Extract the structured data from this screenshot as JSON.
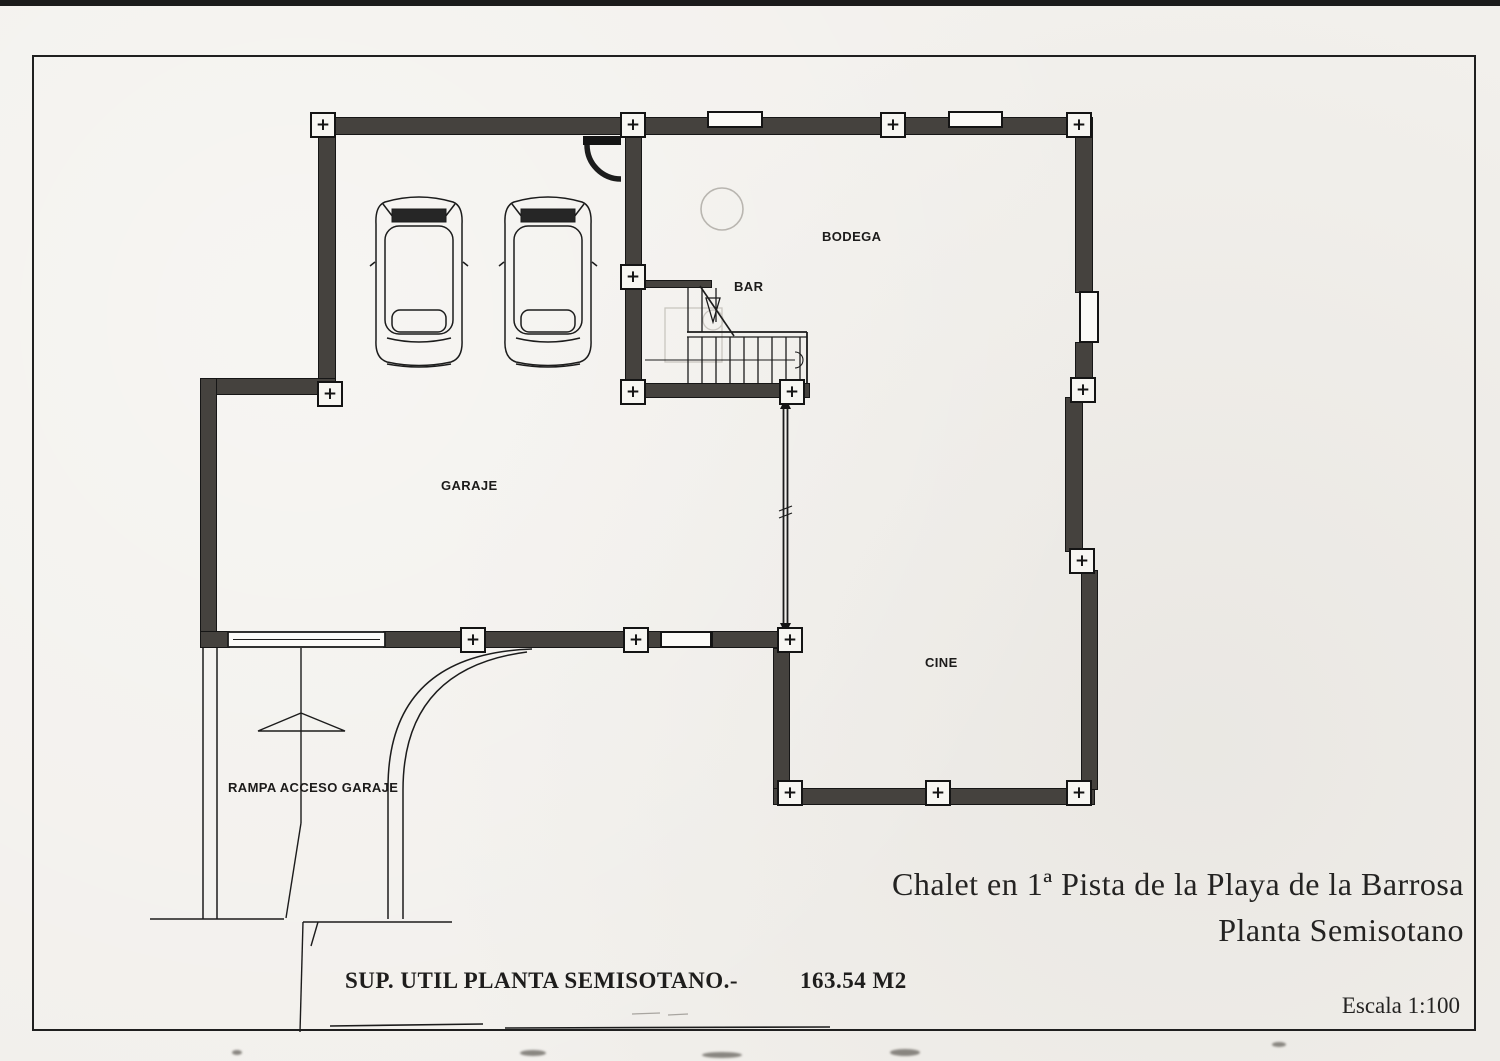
{
  "sheet": {
    "title_line1": "Chalet en 1ª Pista de la Playa de la Barrosa",
    "title_line2": "Planta Semisotano",
    "scale_label": "Escala 1:100",
    "area_label": "SUP. UTIL PLANTA SEMISOTANO.-",
    "area_value": "163.54 M2"
  },
  "rooms": {
    "garaje": {
      "label": "GARAJE"
    },
    "bodega": {
      "label": "BODEGA"
    },
    "bar": {
      "label": "BAR"
    },
    "cine": {
      "label": "CINE"
    },
    "rampa": {
      "label": "RAMPA ACCESO GARAJE"
    }
  },
  "symbols": {
    "pilaster": "+"
  },
  "colors": {
    "paper": "#f2f0ec",
    "wall": "#45423e",
    "line": "#1c1c1c",
    "faint_pencil": "#c9c6c0"
  }
}
